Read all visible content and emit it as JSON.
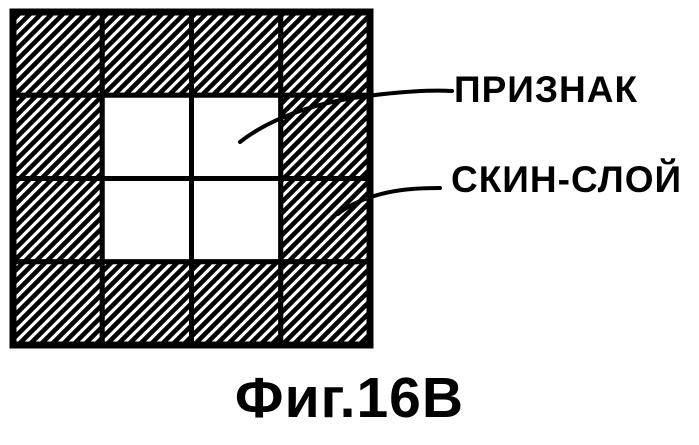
{
  "figure": {
    "caption": "Фиг.16В",
    "labels": [
      {
        "name": "feature",
        "text": "ПРИЗНАК"
      },
      {
        "name": "skin-layer",
        "text": "СКИН-СЛОЙ"
      }
    ],
    "grid": {
      "rows": 4,
      "cols": 4,
      "white_cells": [
        [
          1,
          1
        ],
        [
          1,
          2
        ],
        [
          2,
          1
        ],
        [
          2,
          2
        ]
      ],
      "hatch_style": "diagonal-forward-slash"
    },
    "colors": {
      "ink": "#000000",
      "background": "#ffffff"
    }
  }
}
